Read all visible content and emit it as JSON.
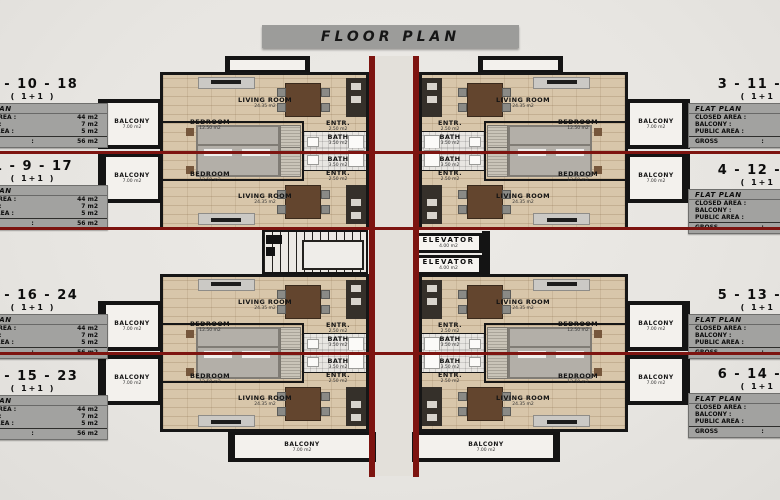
{
  "title": "FLOOR PLAN",
  "left_flats": [
    {
      "numbers": "2 - 10 - 18",
      "type": "( 1+1 )"
    },
    {
      "numbers": "1 - 9 - 17",
      "type": "( 1+1 )"
    },
    {
      "numbers": "8 - 16 - 24",
      "type": "( 1+1 )"
    },
    {
      "numbers": "7 - 15 - 23",
      "type": "( 1+1 )"
    }
  ],
  "right_flats": [
    {
      "numbers": "3 - 11 - 19",
      "type": "( 1+1 )"
    },
    {
      "numbers": "4 - 12 - 20",
      "type": "( 1+1 )"
    },
    {
      "numbers": "5 - 13 - 21",
      "type": "( 1+1 )"
    },
    {
      "numbers": "6 - 14 - 22",
      "type": "( 1+1 )"
    }
  ],
  "flat_table": {
    "header": "FLAT PLAN",
    "rows": [
      {
        "label": "CLOSED AREA :",
        "value": "44 m2"
      },
      {
        "label": "BALCONY :",
        "value": "7 m2"
      },
      {
        "label": "PUBLIC AREA :",
        "value": "5 m2"
      }
    ],
    "gross_label": "GROSS",
    "gross_colon": ":",
    "gross_value": "56 m2"
  },
  "rooms": {
    "living": {
      "name": "LIVING ROOM",
      "area": "24.35 m2"
    },
    "bedroom": {
      "name": "BEDROOM",
      "area": "12.50 m2"
    },
    "entrance": {
      "name": "ENTR.",
      "area": "2.50 m2"
    },
    "bath": {
      "name": "BATH",
      "area": "3.50 m2"
    },
    "balcony": {
      "name": "BALCONY",
      "area": "7.00 m2"
    },
    "elevator": {
      "name": "ELEVATOR",
      "area": "4.00 m2"
    }
  },
  "colors": {
    "section_red": "#7d1410",
    "wall_black": "#161616",
    "table_gray": "#a2a2a0",
    "title_bar_gray": "#9c9c9a",
    "wood_floor": "#d8c6aa"
  }
}
